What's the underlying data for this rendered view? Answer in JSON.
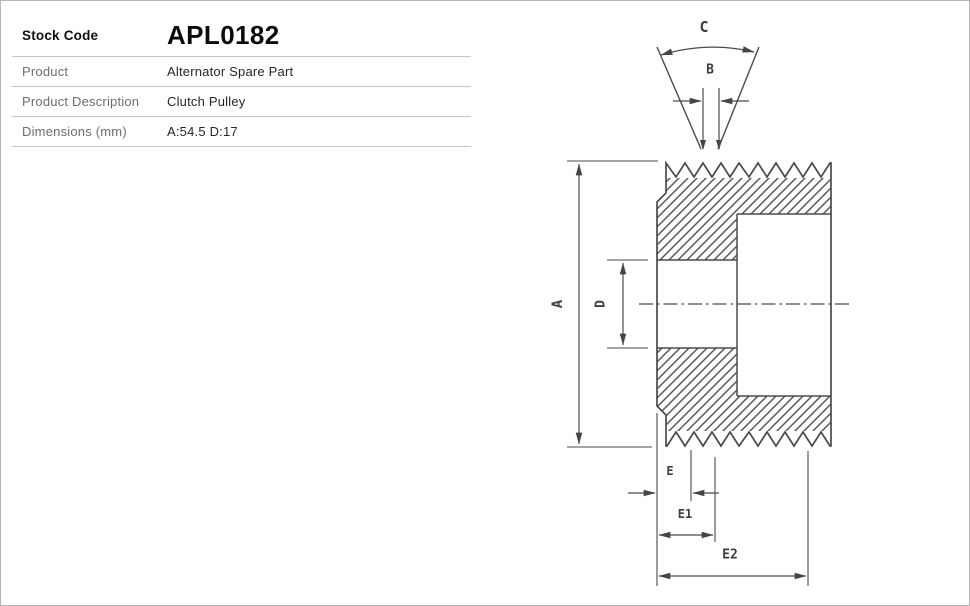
{
  "page": {
    "background": "#ffffff",
    "border_color": "#b5b5b5"
  },
  "spec_table": {
    "rows": [
      {
        "label": "Stock Code",
        "value": "APL0182"
      },
      {
        "label": "Product",
        "value": "Alternator Spare Part"
      },
      {
        "label": "Product Description",
        "value": "Clutch Pulley"
      },
      {
        "label": "Dimensions (mm)",
        "value": "A:54.5 D:17"
      }
    ]
  },
  "diagram": {
    "kind": "clutch-pulley-cross-section-drawing",
    "stroke_color": "#4b4b4b",
    "labels": {
      "groove_angle": "C",
      "rib_pitch": "B",
      "outer_diameter": "A",
      "bore_diameter": "D",
      "edge_offset": "E",
      "offset_1": "E1",
      "offset_2": "E2"
    }
  }
}
